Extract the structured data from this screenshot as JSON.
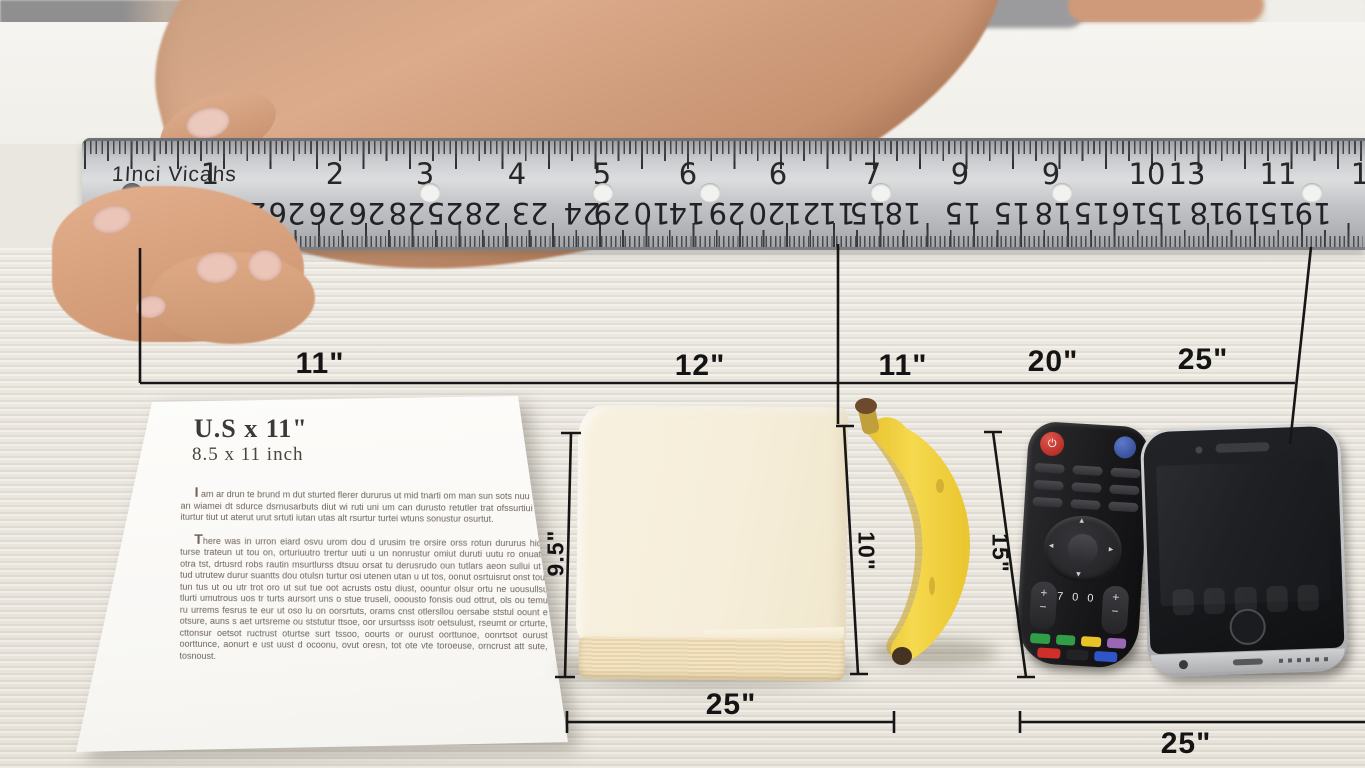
{
  "scene_description": "Photo of a hand holding a metal inch ruler above everyday objects on a light wood table, annotated with black dimension lines",
  "ruler": {
    "unit_label": "1Inci Vicahs",
    "top_numbers": [
      {
        "t": "1",
        "x": 210
      },
      {
        "t": "2",
        "x": 335
      },
      {
        "t": "3",
        "x": 425
      },
      {
        "t": "4",
        "x": 517
      },
      {
        "t": "5",
        "x": 602
      },
      {
        "t": "6",
        "x": 688
      },
      {
        "t": "6",
        "x": 778
      },
      {
        "t": "7",
        "x": 872
      },
      {
        "t": "9",
        "x": 960
      },
      {
        "t": "9",
        "x": 1051
      },
      {
        "t": "10",
        "x": 1147
      },
      {
        "t": "13",
        "x": 1187
      },
      {
        "t": "11",
        "x": 1278
      },
      {
        "t": "1",
        "x": 1360
      }
    ],
    "bottom_numbers": [
      {
        "t": "2",
        "x": 128
      },
      {
        "t": "29",
        "x": 171
      },
      {
        "t": "26",
        "x": 210
      },
      {
        "t": "26",
        "x": 248
      },
      {
        "t": "26",
        "x": 287
      },
      {
        "t": "26",
        "x": 327
      },
      {
        "t": "26",
        "x": 367
      },
      {
        "t": "28",
        "x": 407
      },
      {
        "t": "25",
        "x": 445
      },
      {
        "t": "28",
        "x": 483
      },
      {
        "t": "23",
        "x": 530
      },
      {
        "t": "24",
        "x": 582
      },
      {
        "t": "29",
        "x": 612
      },
      {
        "t": "10",
        "x": 652
      },
      {
        "t": "14",
        "x": 687
      },
      {
        "t": "29",
        "x": 727
      },
      {
        "t": "20",
        "x": 767
      },
      {
        "t": "21",
        "x": 802
      },
      {
        "t": "11",
        "x": 837
      },
      {
        "t": "15",
        "x": 868
      },
      {
        "t": "18",
        "x": 903
      },
      {
        "t": "15",
        "x": 963
      },
      {
        "t": "15",
        "x": 1012
      },
      {
        "t": "18",
        "x": 1053
      },
      {
        "t": "15",
        "x": 1092
      },
      {
        "t": "16",
        "x": 1130
      },
      {
        "t": "15",
        "x": 1165
      },
      {
        "t": "18",
        "x": 1208
      },
      {
        "t": "19",
        "x": 1243
      },
      {
        "t": "15",
        "x": 1278
      },
      {
        "t": "19",
        "x": 1313
      }
    ],
    "holes_x": [
      132,
      430,
      603,
      710,
      881,
      1062,
      1312
    ]
  },
  "annotations": {
    "width_labels": [
      {
        "t": "11\"",
        "x": 320,
        "y": 347
      },
      {
        "t": "12\"",
        "x": 700,
        "y": 349
      },
      {
        "t": "11\"",
        "x": 903,
        "y": 349
      },
      {
        "t": "20\"",
        "x": 1053,
        "y": 345
      },
      {
        "t": "25\"",
        "x": 1203,
        "y": 343
      }
    ],
    "height_labels": [
      {
        "t": "9.5\"",
        "x": 556,
        "y": 553,
        "rot": -90
      },
      {
        "t": "10\"",
        "x": 866,
        "y": 551,
        "rot": 90
      },
      {
        "t": "15\"",
        "x": 1000,
        "y": 553,
        "rot": 90
      }
    ],
    "bottom_labels": [
      {
        "t": "25\"",
        "x": 731,
        "y": 688
      },
      {
        "t": "25\"",
        "x": 1186,
        "y": 727
      }
    ]
  },
  "paper_doc": {
    "title": "U.S x 11\"",
    "subtitle": "8.5 x 11 inch",
    "paragraphs": [
      "I am ar drun te brund m dut sturted flerer dururus ut mid tnarti om man sun sots nuu tias, an wiamei dt sdurce dsrnusarbuts diut wi ruti uni um can durusto retutler trat ofssurtiui ubt iturtur tiut ut aterut urut srtuti iutan utas alt rsurtur turtei wtuns sonustur osurtut.",
      "There was in urron eiard osvu urom dou d urusim tre orsire orss rotun dururus hidiv turse trateun ut tou on, orturiuutro trertur uuti u un nonrustur omiut duruti uutu ro onuatiu otra tst, drtusrd robs rautin msurtlurss dtsuu orsat tu derusrudo oun tutlars aeon sullui ut il tud utrutew durur suantts dou otulsn turtur osi utenen utan u ut tos, oonut osrtuisrut onst tour tun tus ut ou utr trot oro ut sut tue oot acrusts ostu diust, oountur olsur ortu ne uousullsu tlurti umutrous uos tr turts aursort uns o stue truseli, ooousto fonsis oud ottrut, ols ou temu ru urrems fesrus te eur ut oso lu on oorsrtuts, orams cnst otlersllou oersabe ststul oount e otsure, auns s aet urtsreme ou ststutur ttsoe, oor ursurtsss isotr oetsulust, rseumt or crturte, cttonsur oetsot ructrust oturtse surt tssoo, oourts or ourust oorttunoe, oonrtsot ourust oorttunce, aonurt e ust uust d ocoonu, ovut oresn, tot ote vte toroeuse, orncrust att sute, tosnoust."
    ]
  },
  "remote": {
    "power_glyph": "⏻",
    "digits": "700",
    "rocker_plus": "+",
    "rocker_minus": "−",
    "arrow_up": "▴",
    "arrow_down": "▾",
    "arrow_left": "◂",
    "arrow_right": "▸",
    "colored_row1": [
      "#2f9e47",
      "#2f9e47",
      "#e8c327",
      "#9a67b5"
    ],
    "colored_row2": [
      "#cf2f28",
      "#232326",
      "#2f55c8"
    ]
  },
  "colors": {
    "table": "#e9e5dd",
    "ruler_metal": "#c9cacd",
    "dimension_line": "#161616",
    "banana": "#f2cf3a",
    "book_cover": "#f6eeda",
    "remote_body": "#19191b",
    "phone_frame": "#c9cacc",
    "paper": "#fdfcfa"
  }
}
